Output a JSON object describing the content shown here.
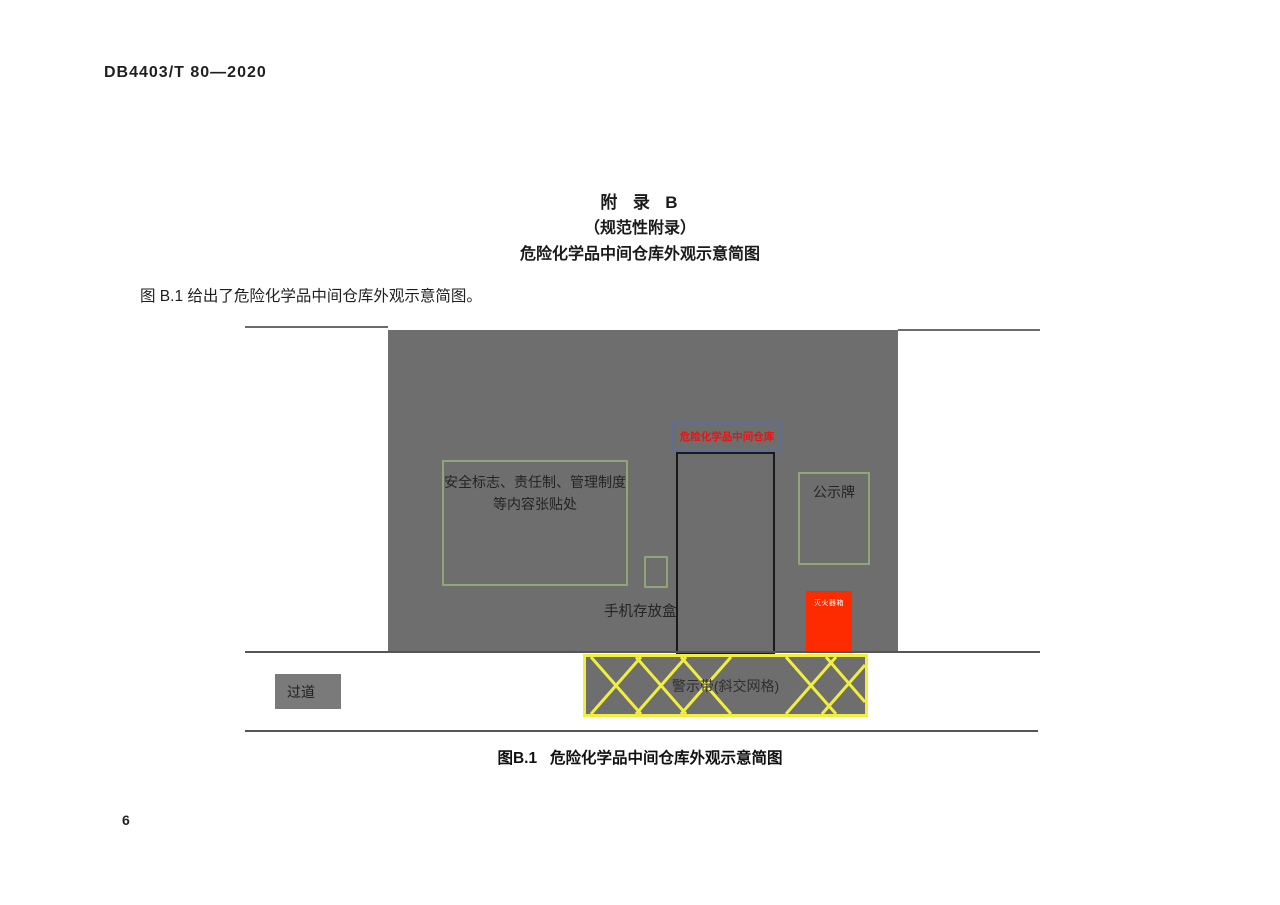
{
  "page": {
    "header": "DB4403/T 80—2020",
    "page_number": "6"
  },
  "appendix": {
    "title": "附  录  B",
    "subtitle": "（规范性附录）",
    "heading": "危险化学品中间仓库外观示意简图",
    "intro": "图 B.1 给出了危险化学品中间仓库外观示意简图。",
    "caption": "图B.1   危险化学品中间仓库外观示意简图"
  },
  "diagram": {
    "door_sign_label": "危险化学品中间仓库",
    "poster_area_line1": "安全标志、责任制、管理制度",
    "poster_area_line2": "等内容张贴处",
    "phone_box_label": "手机存放盒",
    "notice_board_label": "公示牌",
    "fire_extinguisher_label": "灭火器箱",
    "warning_tape_label": "警示带(斜交网格)",
    "aisle_label": "过道",
    "colors": {
      "building_gray": "#6e6e6e",
      "tape_yellow": "#f0ee3f",
      "alert_red": "#fe2b00",
      "sign_text_red": "#ee1111",
      "outline_green": "#8fa678",
      "ground_line_gray": "#6b6b6b"
    }
  }
}
